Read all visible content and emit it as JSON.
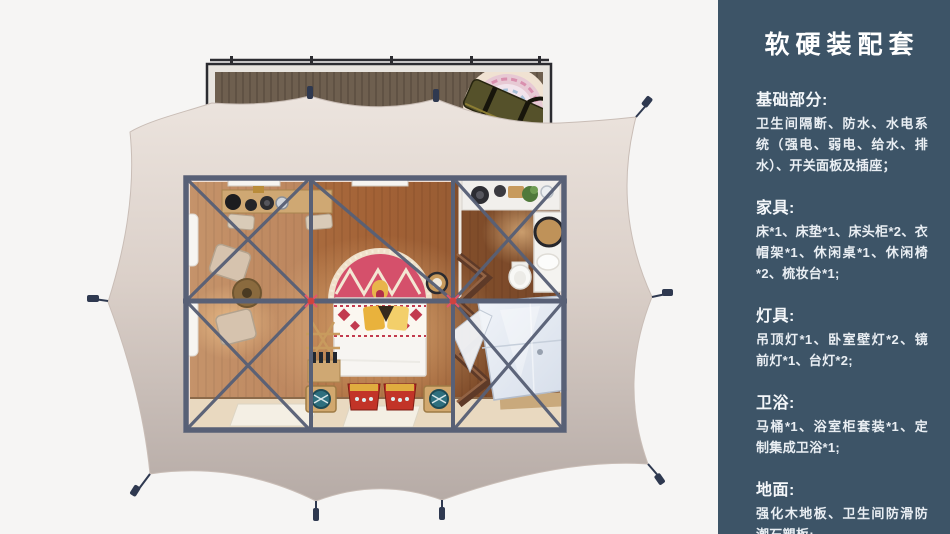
{
  "sidebar": {
    "title": "软硬装配套",
    "sections": [
      {
        "heading": "基础部分:",
        "body": "卫生间隔断、防水、水电系统（强电、弱电、给水、排水）、开关面板及插座；"
      },
      {
        "heading": "家具:",
        "body": "床*1、床垫*1、床头柜*2、衣帽架*1、休闲桌*1、休闲椅*2、梳妆台*1;"
      },
      {
        "heading": "灯具:",
        "body": "吊顶灯*1、卧室壁灯*2、镜前灯*1、台灯*2;"
      },
      {
        "heading": "卫浴:",
        "body": "马桶*1、浴室柜套装*1、定制集成卫浴*1;"
      },
      {
        "heading": "地面:",
        "body": "强化木地板、卫生间防滑防潮石塑板;"
      }
    ],
    "colors": {
      "background": "#3d5467",
      "text": "#ffffff"
    }
  },
  "floorplan": {
    "palette": {
      "tent_canvas": "#d9cec8",
      "deck_wood": "#6e5f4f",
      "steel_frame": "#586076",
      "floor_wood": "#a86538",
      "bed_rug_red": "#d5506b",
      "joint_accent_red": "#cf4340",
      "shower_pod": "#e9eef5"
    }
  }
}
